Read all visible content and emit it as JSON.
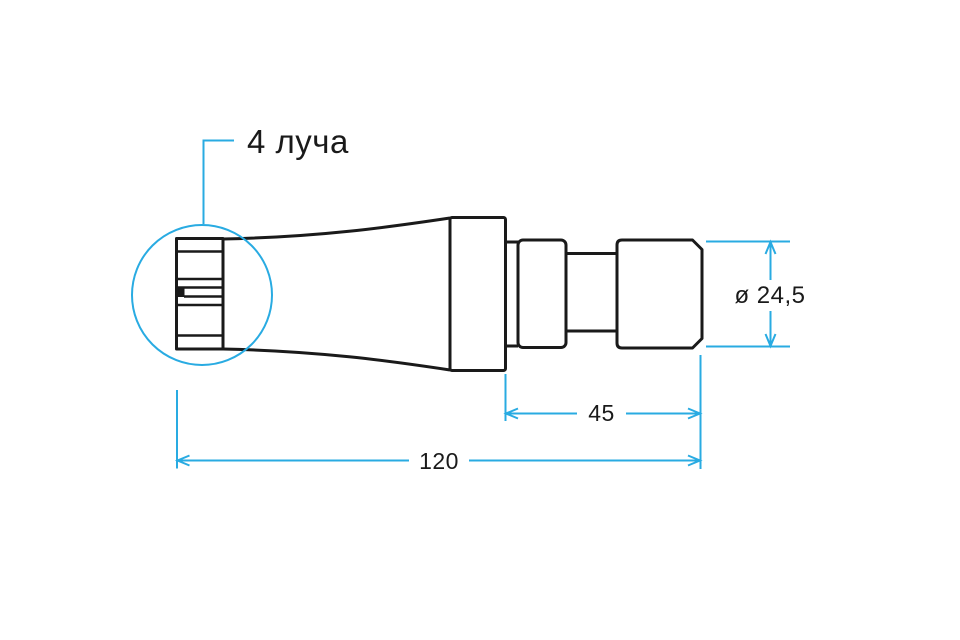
{
  "drawing": {
    "type": "technical-dimension-drawing",
    "callout": {
      "label": "4 луча"
    },
    "dimensions": {
      "diameter": "ø 24,5",
      "section_length": "45",
      "total_length": "120"
    },
    "colors": {
      "outline": "#1a1a1a",
      "dimension_lines": "#29ABE2",
      "background": "#ffffff"
    }
  }
}
